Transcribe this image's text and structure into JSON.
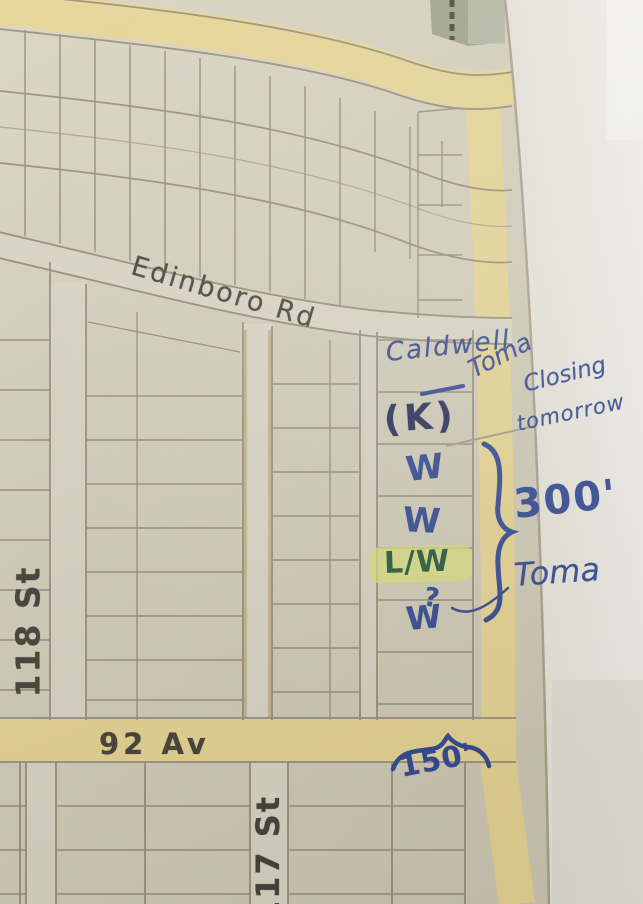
{
  "streets": {
    "edinboro": "Edinboro Rd",
    "st118": "118 St",
    "av92": "92 Av",
    "st117": "117 St"
  },
  "annotations": {
    "caldwell": "Caldwell",
    "toma_top": "Toma",
    "closing": "Closing",
    "tomorrow": "tomorrow",
    "k": "(K)",
    "w1": "W",
    "w2": "W",
    "lw": "L/W",
    "question_mark": "?",
    "w3": "W",
    "dim_300": "300'",
    "toma_bottom": "Toma",
    "dim_150": "150'"
  },
  "colors": {
    "road_yellow": "#e6d493",
    "ink_blue": "#2e4693",
    "ink_navy": "#232a56",
    "ink_green": "#25563b",
    "highlight": "#dce375",
    "pencil": "#948d7b",
    "map_paper": "#d2ccba",
    "margin_paper": "#e9e6de"
  }
}
